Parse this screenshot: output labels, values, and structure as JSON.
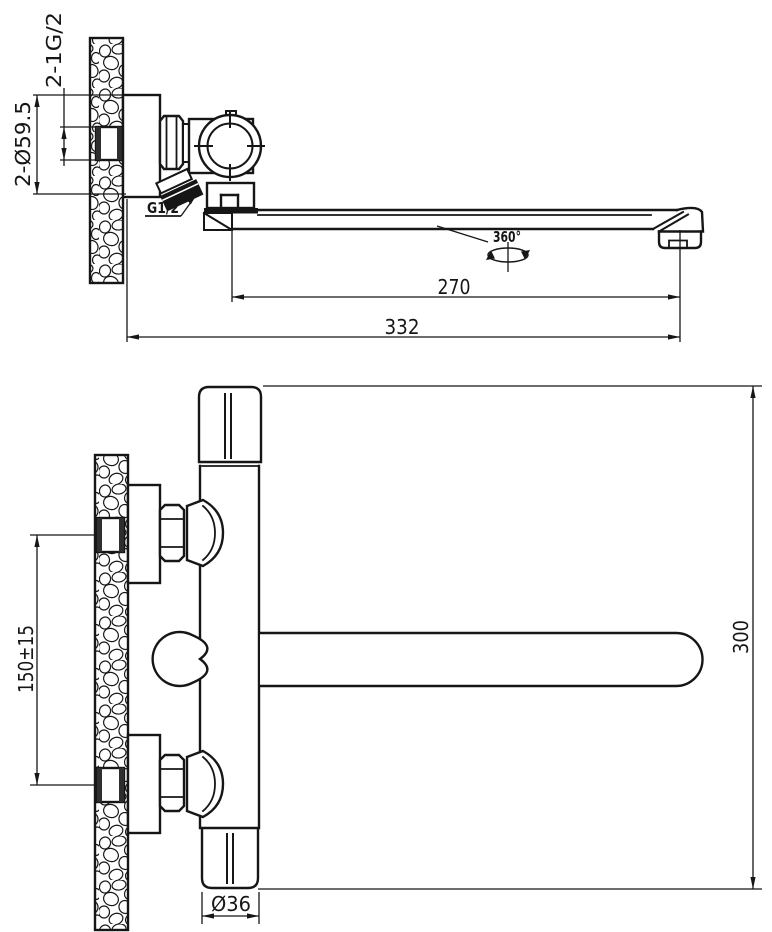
{
  "colors": {
    "background": "#ffffff",
    "line": "#161616"
  },
  "top_view": {
    "labels": {
      "wall_threads": "2-1G/2",
      "flange_diameter": "2-Ø59.5",
      "shower_thread": "G1/2",
      "rotation": "360°",
      "spout_projection": "270",
      "overall_depth": "332"
    }
  },
  "front_view": {
    "labels": {
      "inlet_spacing": "150±15",
      "overall_height": "300",
      "body_diameter": "Ø36"
    }
  }
}
